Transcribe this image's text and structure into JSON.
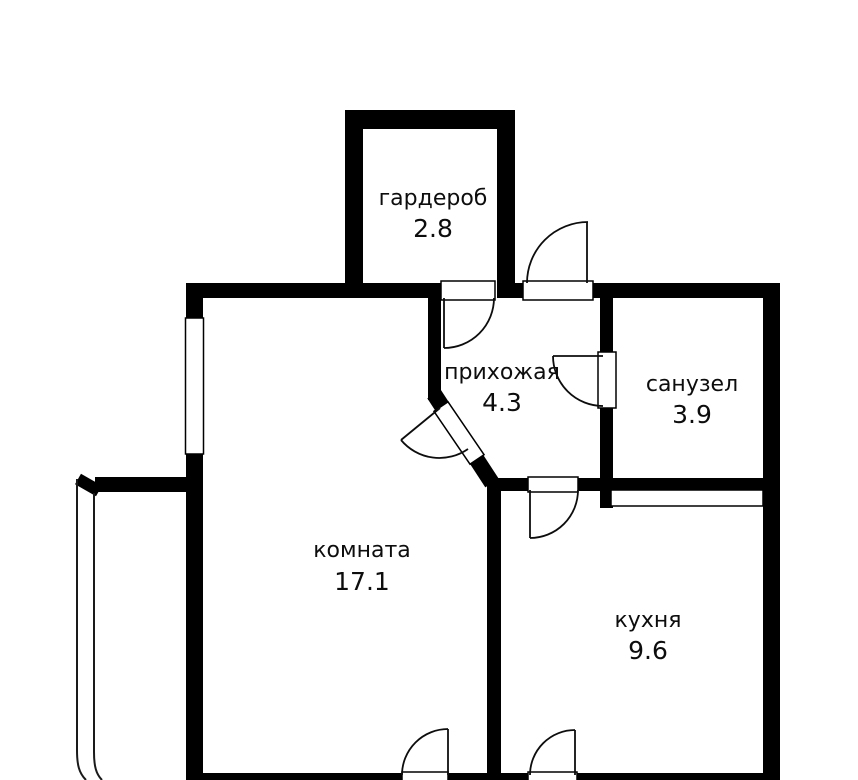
{
  "plan": {
    "background_color": "#ffffff",
    "wall_color": "#000000",
    "line_color": "#000000",
    "rooms": [
      {
        "name": "гардероб",
        "area": "2.8"
      },
      {
        "name": "прихожая",
        "area": "4.3"
      },
      {
        "name": "санузел",
        "area": "3.9"
      },
      {
        "name": "комната",
        "area": "17.1"
      },
      {
        "name": "кухня",
        "area": "9.6"
      }
    ]
  }
}
